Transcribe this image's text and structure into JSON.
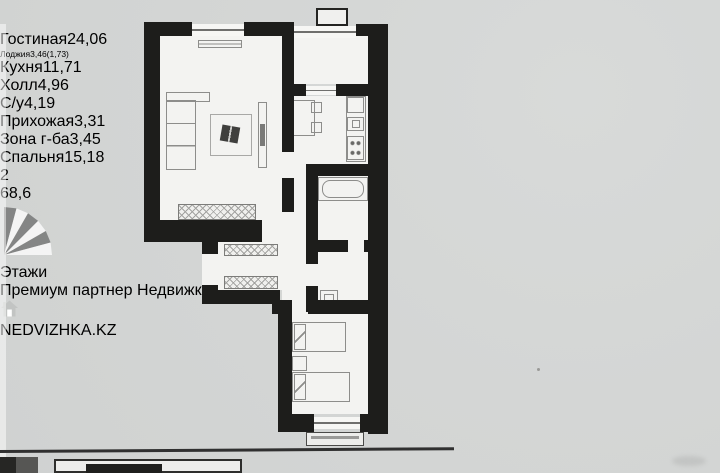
{
  "badge": {
    "room_count": "2",
    "total_area": "68,6"
  },
  "rooms": [
    {
      "name": "Гостиная",
      "area": "24,06"
    },
    {
      "name": "Лоджия",
      "area": "3,46(1,73)"
    },
    {
      "name": "Кухня",
      "area": "11,71"
    },
    {
      "name": "Холл",
      "area": "4,96"
    },
    {
      "name": "С/у",
      "area": "4,19"
    },
    {
      "name": "Прихожая",
      "area": "3,31"
    },
    {
      "name": "Зона г-ба",
      "area": "3,45"
    },
    {
      "name": "Спальня",
      "area": "15,18"
    }
  ],
  "watermark": {
    "brand": "Этажи",
    "tagline": "Премиум партнер Недвижка.kz"
  },
  "footer_logo": {
    "text": "NEDVIZHKA.KZ"
  },
  "colors": {
    "wall": "#1d1d1b",
    "paper": "#d4d6d5",
    "plan_fill": "#f3f3f1",
    "badge_black": "#161614"
  }
}
